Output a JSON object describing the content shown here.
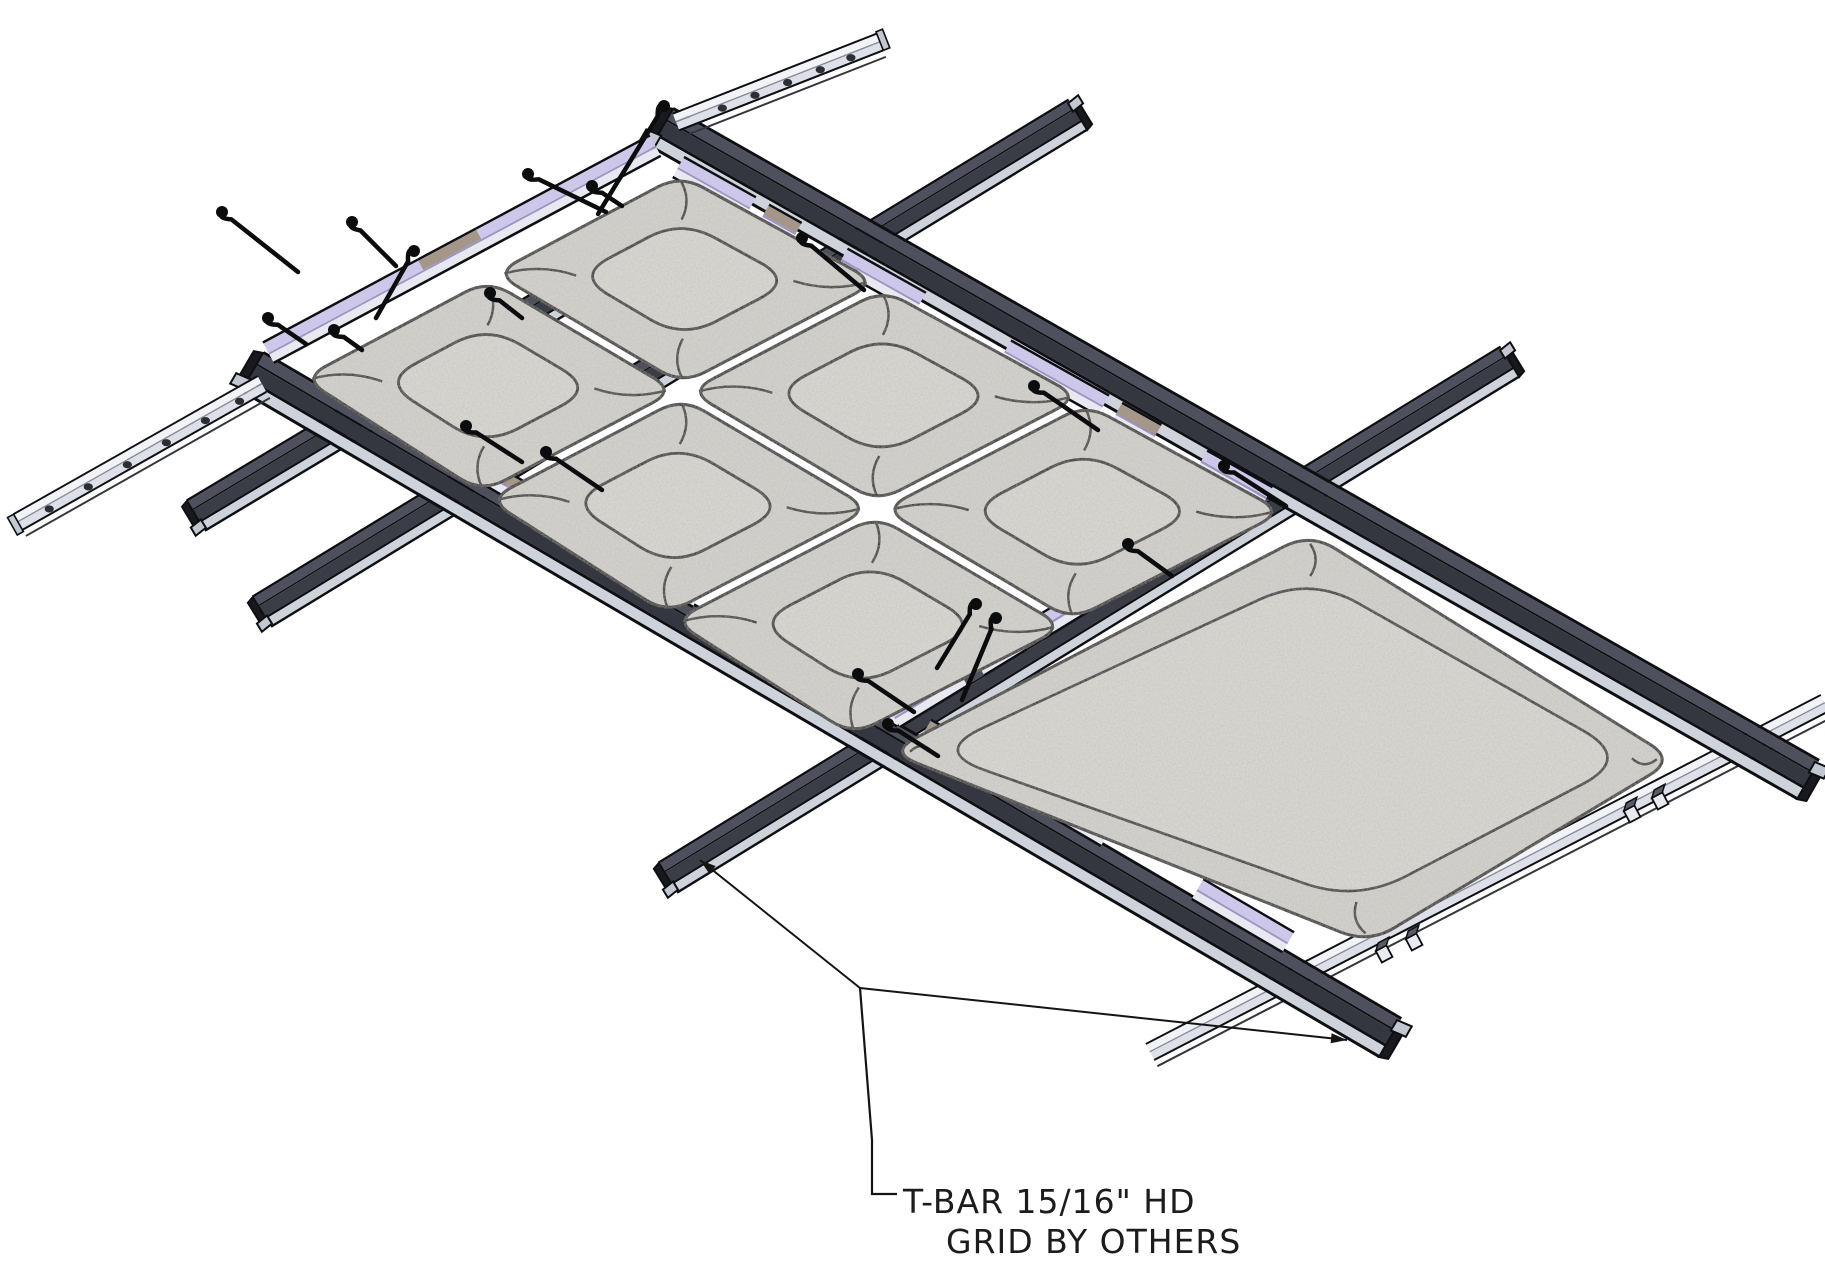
{
  "label": {
    "line1": "T-BAR 15/16\" HD",
    "line2": "GRID BY OTHERS"
  },
  "colors": {
    "background": "#ffffff",
    "edge": "#0e0f13",
    "edge2": "#34363e",
    "runnerTop": "#4e515d",
    "runnerSide": "#34373f",
    "teeSide": "#3a3d46",
    "flange": "#ced2da",
    "railTop": "#f1f3f7",
    "railSide": "#dde0e8",
    "railLine": "#878c98",
    "lavender": "#cdc7e9",
    "lavEdge": "#9d94c6",
    "trimSide": "#e7e8f0",
    "tan": "#a5968a",
    "panelBase": "#d8d6d1",
    "panelDome": "#dedcd7",
    "seam": "#1a1a1a",
    "capWeb": "#17191f",
    "capFlange": "#c3c7d1",
    "clipFace": "#e8eaef",
    "clipTop": "#585c66",
    "wire": "#0b0c0e",
    "leader": "#141414",
    "text": "#1c1c1e",
    "hole": "#2c2e35"
  },
  "diagram": {
    "canvas": {
      "width": 1825,
      "height": 1280
    },
    "runners": [
      {
        "name": "main-runner-far",
        "a": [
          662,
          128
        ],
        "b": [
          1808,
          780
        ],
        "caps": [
          "a",
          "b"
        ]
      },
      {
        "name": "main-runner-near",
        "a": [
          252,
          372
        ],
        "b": [
          1390,
          1038
        ],
        "caps": [
          "a",
          "b"
        ]
      }
    ],
    "tees": [
      {
        "name": "cross-tee-end",
        "a": [
          196,
          516
        ],
        "b": [
          640,
          250
        ],
        "caps": [
          "a"
        ]
      },
      {
        "name": "cross-tee-mid",
        "a": [
          262,
          612
        ],
        "b": [
          1078,
          115
        ],
        "caps": [
          "a",
          "b"
        ]
      },
      {
        "name": "cross-tee-seam",
        "a": [
          668,
          878
        ],
        "b": [
          1510,
          362
        ],
        "caps": [
          "a",
          "b"
        ]
      }
    ],
    "rails": [
      {
        "name": "hanger-rail-left-lower",
        "a": [
          18,
          522
        ],
        "b": [
          262,
          384
        ],
        "holes": [
          0.12,
          0.28,
          0.44,
          0.6,
          0.76,
          0.9
        ],
        "foot": "a"
      },
      {
        "name": "hanger-rail-left-upper",
        "a": [
          676,
          122
        ],
        "b": [
          880,
          42
        ],
        "holes": [
          0.22,
          0.38,
          0.54,
          0.7,
          0.85
        ],
        "foot": "b"
      },
      {
        "name": "hanger-rail-right",
        "a": [
          1150,
          1052
        ],
        "b": [
          1825,
          703
        ],
        "holes": [],
        "foot": null
      }
    ],
    "trims": [
      {
        "name": "edge-trim-left",
        "a": [
          268,
          352
        ],
        "b": [
          655,
          145
        ],
        "segs": [
          [
            0,
            0.4,
            "lav"
          ],
          [
            0.4,
            0.55,
            "tan"
          ],
          [
            0.55,
            1,
            "lav"
          ]
        ]
      },
      {
        "name": "clip-trim-near-runner",
        "a": [
          268,
          344
        ],
        "b": [
          1402,
          1008
        ],
        "segs": [
          [
            0.06,
            0.16,
            "lav"
          ],
          [
            0.19,
            0.24,
            "tan"
          ],
          [
            0.26,
            0.38,
            "lav"
          ],
          [
            0.48,
            0.56,
            "lav"
          ],
          [
            0.58,
            0.62,
            "tan"
          ],
          [
            0.64,
            0.74,
            "lav"
          ],
          [
            0.82,
            0.9,
            "lav"
          ]
        ]
      },
      {
        "name": "clip-trim-far-runner",
        "a": [
          646,
          148
        ],
        "b": [
          1300,
          515
        ],
        "segs": [
          [
            0.05,
            0.16,
            "lav"
          ],
          [
            0.18,
            0.23,
            "tan"
          ],
          [
            0.3,
            0.42,
            "lav"
          ],
          [
            0.55,
            0.7,
            "lav"
          ],
          [
            0.72,
            0.78,
            "tan"
          ],
          [
            0.85,
            0.95,
            "lav"
          ]
        ]
      },
      {
        "name": "clip-trim-seam-tee",
        "a": [
          658,
          861
        ],
        "b": [
          1500,
          345
        ],
        "segs": [
          [
            0.28,
            0.36,
            "lav"
          ],
          [
            0.38,
            0.43,
            "tan"
          ],
          [
            0.45,
            0.55,
            "lav"
          ],
          [
            0.57,
            0.62,
            "lav"
          ]
        ]
      }
    ],
    "panels": {
      "pillowField": {
        "corners": [
          [
            296,
            378
          ],
          [
            680,
            168
          ],
          [
            1290,
            512
          ],
          [
            852,
            742
          ]
        ],
        "cols": 3,
        "rows": 2
      },
      "largePanel": {
        "corners": [
          [
            884,
            752
          ],
          [
            1310,
            528
          ],
          [
            1680,
            760
          ],
          [
            1370,
            948
          ]
        ]
      }
    },
    "hooks": [
      {
        "knob": [
          222,
          212
        ],
        "end": [
          298,
          272
        ]
      },
      {
        "knob": [
          352,
          222
        ],
        "end": [
          396,
          266
        ]
      },
      {
        "knob": [
          268,
          318
        ],
        "end": [
          306,
          344
        ]
      },
      {
        "knob": [
          334,
          330
        ],
        "end": [
          362,
          350
        ]
      },
      {
        "knob": [
          414,
          251
        ],
        "end": [
          376,
          318
        ]
      },
      {
        "knob": [
          490,
          293
        ],
        "end": [
          522,
          318
        ]
      },
      {
        "knob": [
          528,
          174
        ],
        "end": [
          606,
          212
        ]
      },
      {
        "knob": [
          664,
          106
        ],
        "end": [
          598,
          214
        ]
      },
      {
        "knob": [
          592,
          186
        ],
        "end": [
          622,
          206
        ]
      },
      {
        "knob": [
          802,
          238
        ],
        "end": [
          864,
          290
        ]
      },
      {
        "knob": [
          1034,
          386
        ],
        "end": [
          1098,
          430
        ]
      },
      {
        "knob": [
          1224,
          466
        ],
        "end": [
          1286,
          506
        ]
      },
      {
        "knob": [
          976,
          604
        ],
        "end": [
          937,
          668
        ]
      },
      {
        "knob": [
          996,
          618
        ],
        "end": [
          962,
          700
        ]
      },
      {
        "knob": [
          1128,
          544
        ],
        "end": [
          1172,
          576
        ]
      },
      {
        "knob": [
          466,
          426
        ],
        "end": [
          522,
          462
        ]
      },
      {
        "knob": [
          546,
          452
        ],
        "end": [
          602,
          490
        ]
      },
      {
        "knob": [
          858,
          674
        ],
        "end": [
          914,
          712
        ]
      },
      {
        "knob": [
          888,
          724
        ],
        "end": [
          938,
          756
        ]
      }
    ],
    "clips": [
      {
        "at": [
          1382,
          950
        ]
      },
      {
        "at": [
          1412,
          938
        ]
      },
      {
        "at": [
          1630,
          810
        ]
      },
      {
        "at": [
          1658,
          797
        ]
      }
    ],
    "leader": {
      "vertex": [
        860,
        988
      ],
      "arrow1": [
        700,
        860
      ],
      "arrow2": [
        1347,
        1040
      ],
      "drop": [
        [
          860,
          988
        ],
        [
          872,
          1140
        ],
        [
          872,
          1194
        ],
        [
          897,
          1194
        ]
      ],
      "text1": [
        903,
        1213
      ],
      "text2": [
        946,
        1253
      ],
      "fontSize": 33
    }
  }
}
